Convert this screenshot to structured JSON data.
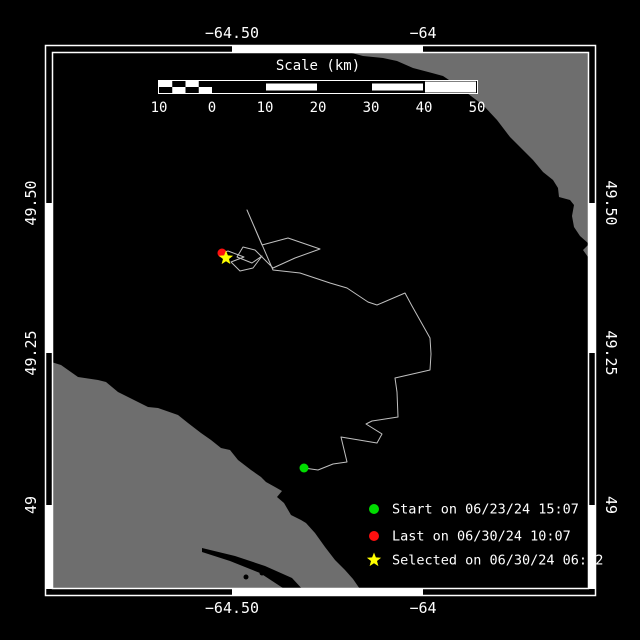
{
  "colors": {
    "background": "#000000",
    "land": "#6E6E6E",
    "water": "#000000",
    "frame": "#FFFFFF",
    "track": "#C0C0C0",
    "text": "#FFFFFF",
    "start_marker": "#00DC00",
    "last_marker": "#FF0F0F",
    "selected_marker": "#FFFF00"
  },
  "axes": {
    "top": [
      {
        "text": "−64.50",
        "x": 232
      },
      {
        "text": "−64",
        "x": 423
      }
    ],
    "bottom": [
      {
        "text": "−64.50",
        "x": 232
      },
      {
        "text": "−64",
        "x": 423
      }
    ],
    "left": [
      {
        "text": "49.50",
        "y": 203
      },
      {
        "text": "49.25",
        "y": 353
      },
      {
        "text": "49",
        "y": 505
      }
    ],
    "right": [
      {
        "text": "49.50",
        "y": 203
      },
      {
        "text": "49.25",
        "y": 353
      },
      {
        "text": "49",
        "y": 505
      }
    ]
  },
  "frame": {
    "outer": [
      45.5,
      45.5,
      550,
      550
    ],
    "inner": [
      52.5,
      52.5,
      536,
      536
    ],
    "white_x": [
      [
        232,
        423
      ]
    ],
    "white_y": [
      [
        203,
        353
      ],
      [
        505,
        589
      ]
    ]
  },
  "scale_bar": {
    "title": "Scale (km)",
    "title_x": 318,
    "title_y": 70,
    "bar": {
      "x0": 158.5,
      "x1": 477.5,
      "y0": 80.5,
      "y1": 93.5
    },
    "ticks": [
      {
        "label": "10",
        "x": 159
      },
      {
        "label": "0",
        "x": 212
      },
      {
        "label": "10",
        "x": 265
      },
      {
        "label": "20",
        "x": 318
      },
      {
        "label": "30",
        "x": 371
      },
      {
        "label": "40",
        "x": 424
      },
      {
        "label": "50",
        "x": 477
      }
    ],
    "labels_y": 112,
    "segments": [
      {
        "from": 212,
        "to": 265,
        "fill": "black"
      },
      {
        "from": 265,
        "to": 318,
        "fill": "white"
      },
      {
        "from": 318,
        "to": 371,
        "fill": "black"
      },
      {
        "from": 371,
        "to": 424,
        "fill": "white"
      },
      {
        "from": 424,
        "to": 477,
        "fill": "white-full"
      }
    ],
    "checker": {
      "from": 159,
      "to": 212,
      "cols": 4
    }
  },
  "legend": {
    "x_marker": 374,
    "x_text": 392,
    "items": [
      {
        "name": "start",
        "marker": "circle",
        "color": "#00DC00",
        "label": "Start on 06/23/24 15:07",
        "y": 509
      },
      {
        "name": "last",
        "marker": "circle",
        "color": "#FF0F0F",
        "label": "Last on 06/30/24 10:07",
        "y": 536
      },
      {
        "name": "selected",
        "marker": "star",
        "color": "#FFFF00",
        "label": "Selected on 06/30/24 06:22",
        "y": 560
      }
    ]
  },
  "chart_data": {
    "type": "map-track",
    "lon_ticks": [
      -64.5,
      -64.0
    ],
    "lat_ticks": [
      49.5,
      49.25,
      49.0
    ],
    "scale_km_per_px": 0.1879,
    "track_px": [
      [
        304,
        468
      ],
      [
        318,
        470
      ],
      [
        333,
        464
      ],
      [
        347,
        462
      ],
      [
        341,
        437
      ],
      [
        377,
        443
      ],
      [
        382,
        434
      ],
      [
        366,
        424
      ],
      [
        372,
        421
      ],
      [
        398,
        417
      ],
      [
        397,
        392
      ],
      [
        395,
        378
      ],
      [
        430,
        370
      ],
      [
        431,
        354
      ],
      [
        430,
        338
      ],
      [
        421,
        322
      ],
      [
        412,
        306
      ],
      [
        405,
        293
      ],
      [
        377,
        305
      ],
      [
        368,
        302
      ],
      [
        347,
        288
      ],
      [
        330,
        283
      ],
      [
        300,
        273
      ],
      [
        273,
        270
      ],
      [
        247,
        210
      ],
      [
        262,
        245
      ],
      [
        288,
        238
      ],
      [
        320,
        249
      ],
      [
        295,
        258
      ],
      [
        273,
        268
      ],
      [
        255,
        250
      ],
      [
        243,
        247
      ],
      [
        237,
        257
      ],
      [
        252,
        263
      ],
      [
        262,
        256
      ],
      [
        253,
        268
      ],
      [
        240,
        271
      ],
      [
        231,
        262
      ],
      [
        244,
        257
      ],
      [
        228,
        251
      ],
      [
        222,
        253
      ]
    ],
    "markers": [
      {
        "name": "start",
        "px": [
          304,
          468
        ]
      },
      {
        "name": "last",
        "px": [
          222,
          253
        ]
      },
      {
        "name": "selected",
        "px": [
          226,
          258
        ]
      }
    ],
    "land_px": {
      "northeast": [
        [
          348,
          46
        ],
        [
          348,
          52
        ],
        [
          363,
          56
        ],
        [
          383,
          58
        ],
        [
          397,
          61
        ],
        [
          413,
          68
        ],
        [
          432,
          73
        ],
        [
          443,
          76
        ],
        [
          455,
          84
        ],
        [
          467,
          93
        ],
        [
          483,
          105
        ],
        [
          497,
          120
        ],
        [
          510,
          137
        ],
        [
          523,
          150
        ],
        [
          533,
          160
        ],
        [
          543,
          172
        ],
        [
          553,
          180
        ],
        [
          558,
          188
        ],
        [
          559,
          197
        ],
        [
          570,
          200
        ],
        [
          574,
          205
        ],
        [
          572,
          216
        ],
        [
          574,
          227
        ],
        [
          580,
          236
        ],
        [
          589,
          244
        ],
        [
          583,
          250
        ],
        [
          588,
          257
        ],
        [
          592,
          261
        ],
        [
          592,
          46
        ]
      ],
      "southwest": [
        [
          45,
          360
        ],
        [
          61,
          365
        ],
        [
          78,
          377
        ],
        [
          98,
          380
        ],
        [
          106,
          382
        ],
        [
          118,
          392
        ],
        [
          138,
          402
        ],
        [
          148,
          407
        ],
        [
          158,
          408
        ],
        [
          178,
          415
        ],
        [
          188,
          423
        ],
        [
          201,
          433
        ],
        [
          211,
          440
        ],
        [
          221,
          448
        ],
        [
          230,
          450
        ],
        [
          238,
          460
        ],
        [
          251,
          470
        ],
        [
          261,
          477
        ],
        [
          266,
          482
        ],
        [
          275,
          487
        ],
        [
          282,
          491
        ],
        [
          277,
          497
        ],
        [
          284,
          503
        ],
        [
          291,
          515
        ],
        [
          301,
          520
        ],
        [
          306,
          523
        ],
        [
          315,
          533
        ],
        [
          325,
          547
        ],
        [
          335,
          560
        ],
        [
          345,
          570
        ],
        [
          353,
          579
        ],
        [
          362,
          592
        ],
        [
          45,
          592
        ]
      ],
      "inlet_water": [
        [
          202,
          548
        ],
        [
          235,
          556
        ],
        [
          265,
          566
        ],
        [
          292,
          578
        ],
        [
          305,
          592
        ],
        [
          289,
          592
        ],
        [
          260,
          573
        ],
        [
          230,
          561
        ],
        [
          202,
          552
        ]
      ],
      "ponds": [
        [
          246,
          577
        ],
        [
          262,
          573
        ]
      ]
    }
  }
}
